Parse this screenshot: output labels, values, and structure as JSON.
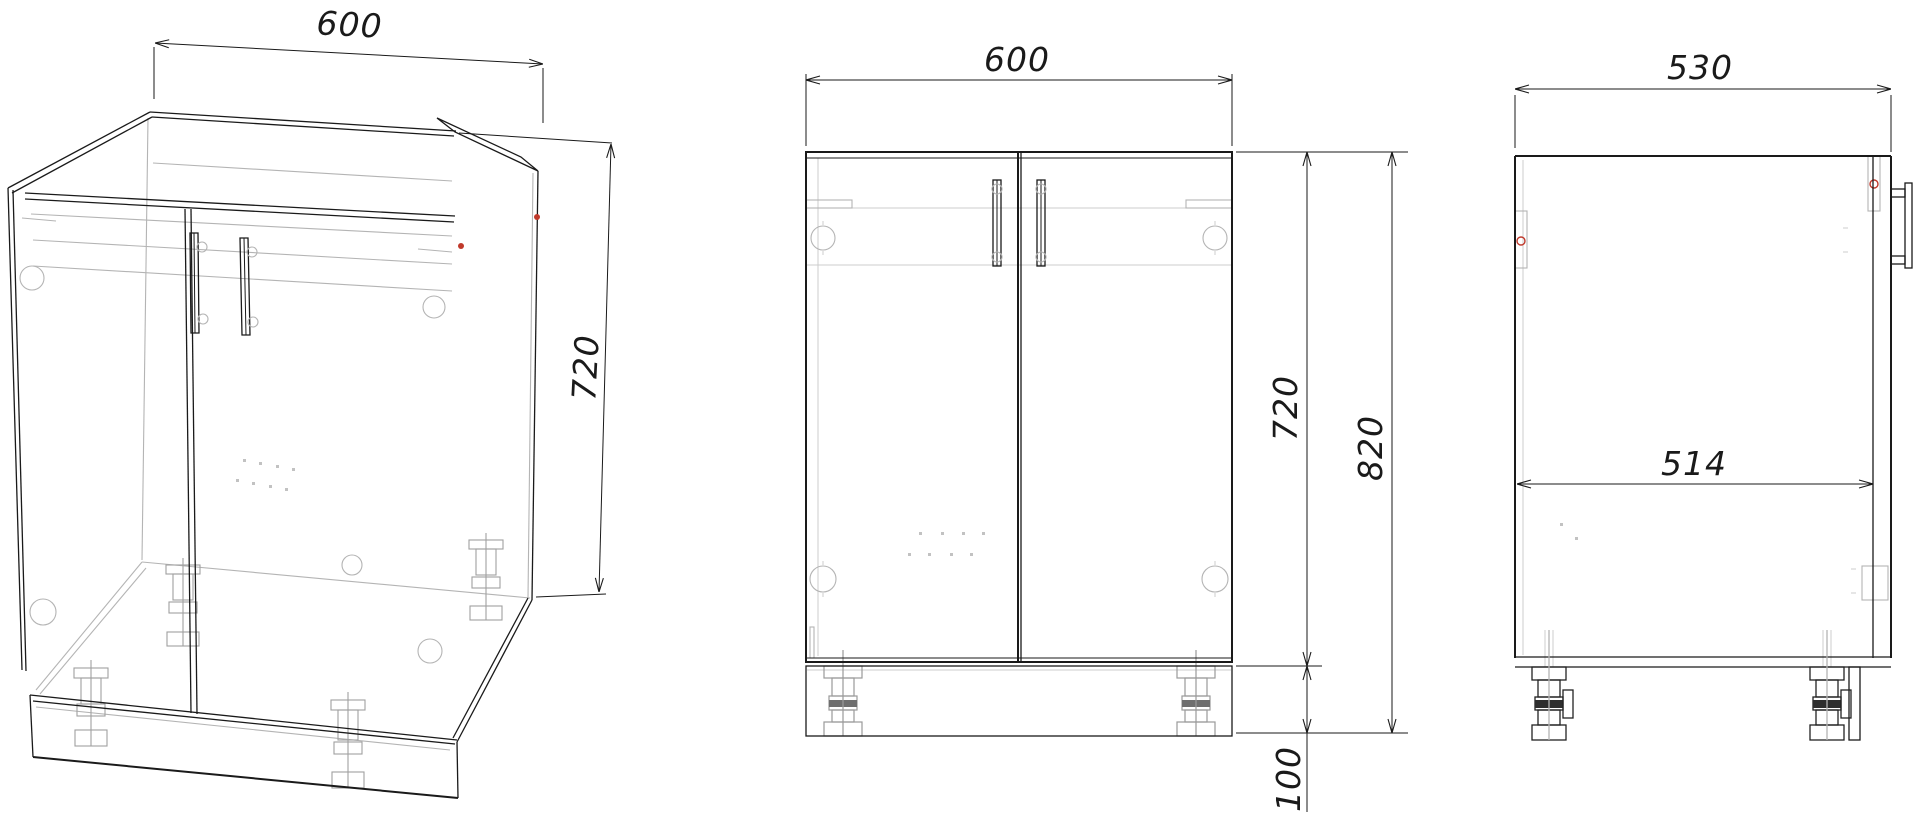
{
  "drawing": {
    "kind": "cabinet technical drawing, three views",
    "views": [
      "isometric",
      "front",
      "side"
    ]
  },
  "dimensions": {
    "iso": {
      "width": "600",
      "height": "720"
    },
    "front": {
      "width": "600",
      "door_height": "720",
      "overall_height": "820",
      "leg_height": "100"
    },
    "side": {
      "depth": "530",
      "interior_depth": "514"
    }
  },
  "colors": {
    "line": "#1a1a1a",
    "secondary": "#b4b4b4",
    "accent": "#c0392b",
    "background": "#ffffff"
  }
}
